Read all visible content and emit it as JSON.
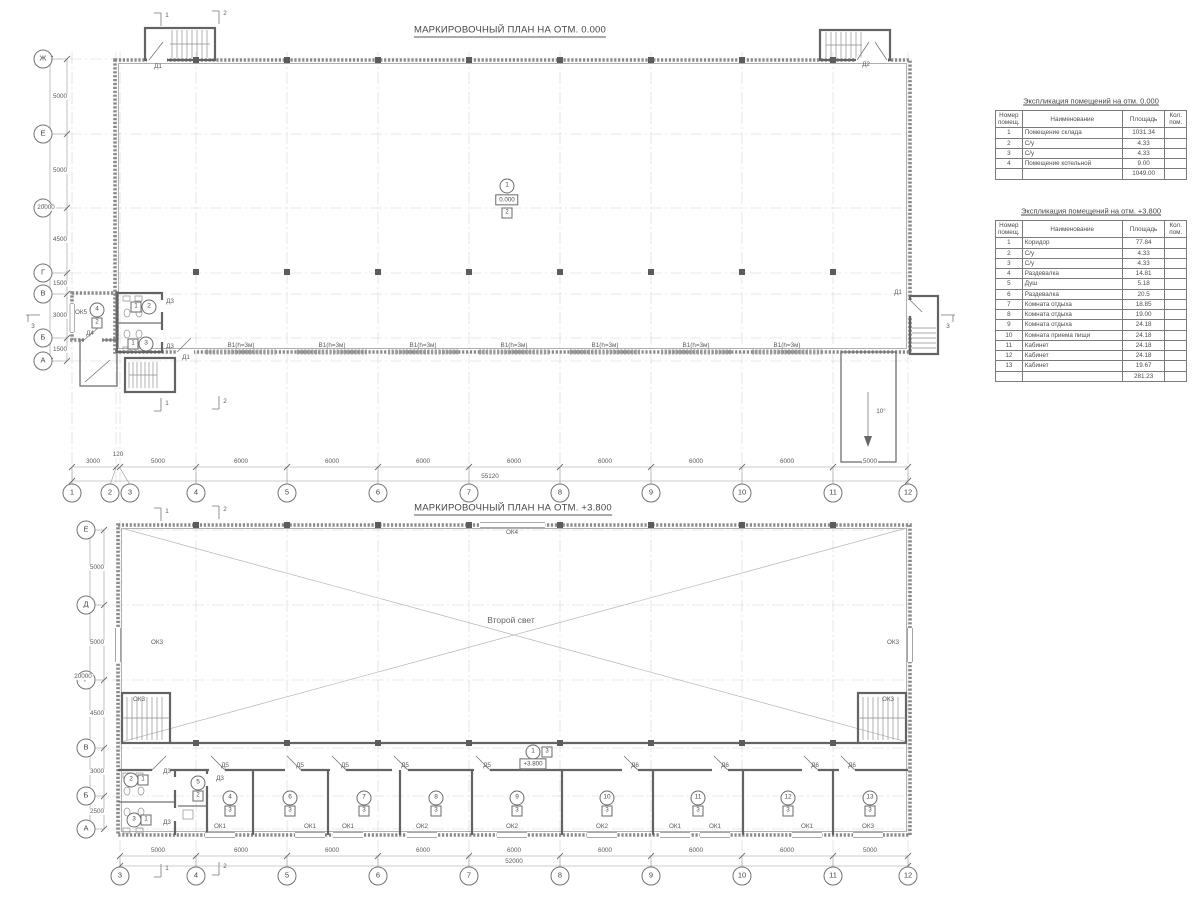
{
  "plans": [
    {
      "title": "МАРКИРОВОЧНЫЙ ПЛАН НА ОТМ. 0.000"
    },
    {
      "title": "МАРКИРОВОЧНЫЙ ПЛАН НА ОТМ. +3.800"
    }
  ],
  "axis_bubbles": [
    {
      "t": "1",
      "x": 72,
      "y": 493
    },
    {
      "t": "2",
      "x": 110,
      "y": 493
    },
    {
      "t": "3",
      "x": 130,
      "y": 493
    },
    {
      "t": "4",
      "x": 196,
      "y": 493
    },
    {
      "t": "5",
      "x": 287,
      "y": 493
    },
    {
      "t": "6",
      "x": 378,
      "y": 493
    },
    {
      "t": "7",
      "x": 469,
      "y": 493
    },
    {
      "t": "8",
      "x": 560,
      "y": 493
    },
    {
      "t": "9",
      "x": 651,
      "y": 493
    },
    {
      "t": "10",
      "x": 742,
      "y": 493
    },
    {
      "t": "11",
      "x": 833,
      "y": 493
    },
    {
      "t": "12",
      "x": 908,
      "y": 493
    },
    {
      "t": "Ж",
      "x": 43,
      "y": 59
    },
    {
      "t": "Е",
      "x": 43,
      "y": 134
    },
    {
      "t": "Д",
      "x": 43,
      "y": 208
    },
    {
      "t": "Г",
      "x": 43,
      "y": 273
    },
    {
      "t": "В",
      "x": 43,
      "y": 294
    },
    {
      "t": "Б",
      "x": 43,
      "y": 338
    },
    {
      "t": "А",
      "x": 43,
      "y": 361
    },
    {
      "t": "3",
      "x": 120,
      "y": 876
    },
    {
      "t": "4",
      "x": 196,
      "y": 876
    },
    {
      "t": "5",
      "x": 287,
      "y": 876
    },
    {
      "t": "6",
      "x": 378,
      "y": 876
    },
    {
      "t": "7",
      "x": 469,
      "y": 876
    },
    {
      "t": "8",
      "x": 560,
      "y": 876
    },
    {
      "t": "9",
      "x": 651,
      "y": 876
    },
    {
      "t": "10",
      "x": 742,
      "y": 876
    },
    {
      "t": "11",
      "x": 833,
      "y": 876
    },
    {
      "t": "12",
      "x": 908,
      "y": 876
    },
    {
      "t": "Е",
      "x": 86,
      "y": 530
    },
    {
      "t": "Д",
      "x": 86,
      "y": 605
    },
    {
      "t": "Г",
      "x": 86,
      "y": 680
    },
    {
      "t": "В",
      "x": 86,
      "y": 748
    },
    {
      "t": "Б",
      "x": 86,
      "y": 796
    },
    {
      "t": "А",
      "x": 86,
      "y": 829
    }
  ],
  "dimensions": [
    {
      "t": "3000",
      "x": 93,
      "y": 462
    },
    {
      "t": "120",
      "x": 118,
      "y": 455
    },
    {
      "t": "5000",
      "x": 158,
      "y": 462
    },
    {
      "t": "6000",
      "x": 241,
      "y": 462
    },
    {
      "t": "6000",
      "x": 332,
      "y": 462
    },
    {
      "t": "6000",
      "x": 423,
      "y": 462
    },
    {
      "t": "6000",
      "x": 514,
      "y": 462
    },
    {
      "t": "6000",
      "x": 605,
      "y": 462
    },
    {
      "t": "6000",
      "x": 696,
      "y": 462
    },
    {
      "t": "6000",
      "x": 787,
      "y": 462
    },
    {
      "t": "5000",
      "x": 870,
      "y": 462
    },
    {
      "t": "55120",
      "x": 490,
      "y": 477
    },
    {
      "t": "5000",
      "x": 60,
      "y": 97,
      "rot": 1
    },
    {
      "t": "5000",
      "x": 60,
      "y": 171,
      "rot": 1
    },
    {
      "t": "4500",
      "x": 60,
      "y": 240,
      "rot": 1
    },
    {
      "t": "1500",
      "x": 60,
      "y": 284,
      "rot": 1
    },
    {
      "t": "3000",
      "x": 60,
      "y": 316,
      "rot": 1
    },
    {
      "t": "1500",
      "x": 60,
      "y": 350,
      "rot": 1
    },
    {
      "t": "20000",
      "x": 46,
      "y": 208,
      "rot": 1
    },
    {
      "t": "5000",
      "x": 158,
      "y": 851
    },
    {
      "t": "6000",
      "x": 241,
      "y": 851
    },
    {
      "t": "6000",
      "x": 332,
      "y": 851
    },
    {
      "t": "6000",
      "x": 423,
      "y": 851
    },
    {
      "t": "6000",
      "x": 514,
      "y": 851
    },
    {
      "t": "6000",
      "x": 605,
      "y": 851
    },
    {
      "t": "6000",
      "x": 696,
      "y": 851
    },
    {
      "t": "6000",
      "x": 787,
      "y": 851
    },
    {
      "t": "5000",
      "x": 870,
      "y": 851
    },
    {
      "t": "52000",
      "x": 514,
      "y": 862
    },
    {
      "t": "5000",
      "x": 97,
      "y": 568,
      "rot": 1
    },
    {
      "t": "5000",
      "x": 97,
      "y": 643,
      "rot": 1
    },
    {
      "t": "4500",
      "x": 97,
      "y": 714,
      "rot": 1
    },
    {
      "t": "3000",
      "x": 97,
      "y": 772,
      "rot": 1
    },
    {
      "t": "2500",
      "x": 97,
      "y": 812,
      "rot": 1
    },
    {
      "t": "20000",
      "x": 83,
      "y": 677,
      "rot": 1
    }
  ],
  "annotations": [
    {
      "t": "Д1",
      "x": 158,
      "y": 67,
      "name": "door-label-d1"
    },
    {
      "t": "Д2",
      "x": 866,
      "y": 65,
      "name": "door-label-d2"
    },
    {
      "t": "Д1",
      "x": 186,
      "y": 358,
      "name": "door-label-d1"
    },
    {
      "t": "Д1",
      "x": 898,
      "y": 293,
      "name": "door-label-d1"
    },
    {
      "t": "Д3",
      "x": 170,
      "y": 302,
      "name": "door-label-d3"
    },
    {
      "t": "Д3",
      "x": 170,
      "y": 347,
      "name": "door-label-d3"
    },
    {
      "t": "Д4",
      "x": 90,
      "y": 334,
      "name": "door-label-d4"
    },
    {
      "t": "ОК5",
      "x": 81,
      "y": 313,
      "name": "window-label-ok5"
    },
    {
      "t": "В1(h=3м)",
      "x": 241,
      "y": 346,
      "name": "opening-label-v1"
    },
    {
      "t": "В1(h=3м)",
      "x": 332,
      "y": 346,
      "name": "opening-label-v1"
    },
    {
      "t": "В1(h=3м)",
      "x": 423,
      "y": 346,
      "name": "opening-label-v1"
    },
    {
      "t": "В1(h=3м)",
      "x": 514,
      "y": 346,
      "name": "opening-label-v1"
    },
    {
      "t": "В1(h=3м)",
      "x": 605,
      "y": 346,
      "name": "opening-label-v1"
    },
    {
      "t": "В1(h=3м)",
      "x": 696,
      "y": 346,
      "name": "opening-label-v1"
    },
    {
      "t": "В1(h=3м)",
      "x": 787,
      "y": 346,
      "name": "opening-label-v1"
    },
    {
      "t": "10°",
      "x": 881,
      "y": 412,
      "name": "ramp-slope-label"
    },
    {
      "t": "1",
      "x": 167,
      "y": 16,
      "name": "section-mark-1"
    },
    {
      "t": "2",
      "x": 225,
      "y": 14,
      "name": "section-mark-2"
    },
    {
      "t": "1",
      "x": 167,
      "y": 404,
      "name": "section-mark-1"
    },
    {
      "t": "2",
      "x": 225,
      "y": 402,
      "name": "section-mark-2"
    },
    {
      "t": "3",
      "x": 33,
      "y": 327,
      "name": "section-mark-3"
    },
    {
      "t": "3",
      "x": 948,
      "y": 327,
      "name": "section-mark-3"
    },
    {
      "t": "ОК4",
      "x": 512,
      "y": 533,
      "name": "window-label-ok4"
    },
    {
      "t": "ОК3",
      "x": 157,
      "y": 643,
      "name": "window-label-ok3"
    },
    {
      "t": "ОК3",
      "x": 893,
      "y": 643,
      "name": "window-label-ok3"
    },
    {
      "t": "ОК3",
      "x": 139,
      "y": 700,
      "name": "window-label-ok3"
    },
    {
      "t": "ОК3",
      "x": 888,
      "y": 700,
      "name": "window-label-ok3"
    },
    {
      "t": "Второй свет",
      "x": 511,
      "y": 620,
      "cls": "md",
      "name": "second-light-label"
    },
    {
      "t": "Д3",
      "x": 167,
      "y": 772,
      "name": "door-label-d3"
    },
    {
      "t": "Д3",
      "x": 220,
      "y": 779,
      "name": "door-label-d3"
    },
    {
      "t": "Д3",
      "x": 167,
      "y": 823,
      "name": "door-label-d3"
    },
    {
      "t": "Д5",
      "x": 225,
      "y": 766,
      "name": "door-label-d5"
    },
    {
      "t": "Д5",
      "x": 300,
      "y": 766,
      "name": "door-label-d5"
    },
    {
      "t": "Д5",
      "x": 345,
      "y": 766,
      "name": "door-label-d5"
    },
    {
      "t": "Д5",
      "x": 405,
      "y": 766,
      "name": "door-label-d5"
    },
    {
      "t": "Д5",
      "x": 487,
      "y": 766,
      "name": "door-label-d5"
    },
    {
      "t": "Д6",
      "x": 635,
      "y": 766,
      "name": "door-label-d6"
    },
    {
      "t": "Д6",
      "x": 725,
      "y": 766,
      "name": "door-label-d6"
    },
    {
      "t": "Д6",
      "x": 815,
      "y": 766,
      "name": "door-label-d6"
    },
    {
      "t": "Д6",
      "x": 852,
      "y": 766,
      "name": "door-label-d6"
    },
    {
      "t": "ОК1",
      "x": 220,
      "y": 827,
      "name": "window-label-ok1"
    },
    {
      "t": "ОК1",
      "x": 310,
      "y": 827,
      "name": "window-label-ok1"
    },
    {
      "t": "ОК1",
      "x": 348,
      "y": 827,
      "name": "window-label-ok1"
    },
    {
      "t": "ОК2",
      "x": 422,
      "y": 827,
      "name": "window-label-ok2"
    },
    {
      "t": "ОК2",
      "x": 512,
      "y": 827,
      "name": "window-label-ok2"
    },
    {
      "t": "ОК2",
      "x": 602,
      "y": 827,
      "name": "window-label-ok2"
    },
    {
      "t": "ОК1",
      "x": 675,
      "y": 827,
      "name": "window-label-ok1"
    },
    {
      "t": "ОК1",
      "x": 715,
      "y": 827,
      "name": "window-label-ok1"
    },
    {
      "t": "ОК1",
      "x": 807,
      "y": 827,
      "name": "window-label-ok1"
    },
    {
      "t": "ОК3",
      "x": 868,
      "y": 827,
      "name": "window-label-ok3"
    },
    {
      "t": "1",
      "x": 167,
      "y": 512,
      "name": "section-mark-1"
    },
    {
      "t": "2",
      "x": 225,
      "y": 510,
      "name": "section-mark-2"
    },
    {
      "t": "1",
      "x": 167,
      "y": 869,
      "name": "section-mark-1"
    },
    {
      "t": "2",
      "x": 225,
      "y": 867,
      "name": "section-mark-2"
    }
  ],
  "markers": [
    {
      "kind": "circle",
      "t": "1",
      "x": 507,
      "y": 186
    },
    {
      "kind": "box",
      "t": "0.000",
      "x": 507,
      "y": 200
    },
    {
      "kind": "square",
      "t": "2",
      "x": 507,
      "y": 213
    },
    {
      "kind": "circle",
      "t": "4",
      "x": 97,
      "y": 310
    },
    {
      "kind": "square",
      "t": "2",
      "x": 97,
      "y": 323
    },
    {
      "kind": "square",
      "t": "1",
      "x": 136,
      "y": 307
    },
    {
      "kind": "circle",
      "t": "2",
      "x": 149,
      "y": 307
    },
    {
      "kind": "square",
      "t": "1",
      "x": 133,
      "y": 344
    },
    {
      "kind": "circle",
      "t": "3",
      "x": 146,
      "y": 344
    },
    {
      "kind": "circle",
      "t": "1",
      "x": 533,
      "y": 752
    },
    {
      "kind": "square",
      "t": "3",
      "x": 547,
      "y": 752
    },
    {
      "kind": "box",
      "t": "+3.800",
      "x": 533,
      "y": 764
    },
    {
      "kind": "circle",
      "t": "2",
      "x": 131,
      "y": 780
    },
    {
      "kind": "square",
      "t": "1",
      "x": 143,
      "y": 780
    },
    {
      "kind": "circle",
      "t": "3",
      "x": 134,
      "y": 820
    },
    {
      "kind": "square",
      "t": "1",
      "x": 146,
      "y": 820
    },
    {
      "kind": "circle",
      "t": "5",
      "x": 198,
      "y": 783
    },
    {
      "kind": "square",
      "t": "2",
      "x": 198,
      "y": 796
    },
    {
      "kind": "circle",
      "t": "4",
      "x": 230,
      "y": 798
    },
    {
      "kind": "square",
      "t": "3",
      "x": 230,
      "y": 811
    },
    {
      "kind": "circle",
      "t": "6",
      "x": 290,
      "y": 798
    },
    {
      "kind": "square",
      "t": "3",
      "x": 290,
      "y": 811
    },
    {
      "kind": "circle",
      "t": "7",
      "x": 364,
      "y": 798
    },
    {
      "kind": "square",
      "t": "3",
      "x": 364,
      "y": 811
    },
    {
      "kind": "circle",
      "t": "8",
      "x": 436,
      "y": 798
    },
    {
      "kind": "square",
      "t": "3",
      "x": 436,
      "y": 811
    },
    {
      "kind": "circle",
      "t": "9",
      "x": 517,
      "y": 798
    },
    {
      "kind": "square",
      "t": "3",
      "x": 517,
      "y": 811
    },
    {
      "kind": "circle",
      "t": "10",
      "x": 607,
      "y": 798
    },
    {
      "kind": "square",
      "t": "3",
      "x": 607,
      "y": 811
    },
    {
      "kind": "circle",
      "t": "11",
      "x": 698,
      "y": 798
    },
    {
      "kind": "square",
      "t": "3",
      "x": 698,
      "y": 811
    },
    {
      "kind": "circle",
      "t": "12",
      "x": 788,
      "y": 798
    },
    {
      "kind": "square",
      "t": "3",
      "x": 788,
      "y": 811
    },
    {
      "kind": "circle",
      "t": "13",
      "x": 870,
      "y": 798
    },
    {
      "kind": "square",
      "t": "3",
      "x": 870,
      "y": 811
    }
  ],
  "tables": [
    {
      "title": "Экспликация помещений на отм. 0.000",
      "headers": [
        "Номер\nпомещ.",
        "Наименование",
        "Площадь",
        "Кол.\nпом."
      ],
      "rows": [
        [
          "1",
          "Помещение склада",
          "1031.34",
          ""
        ],
        [
          "2",
          "С/у",
          "4.33",
          ""
        ],
        [
          "3",
          "С/у",
          "4.33",
          ""
        ],
        [
          "4",
          "Помещение котельной",
          "9.00",
          ""
        ]
      ],
      "total": "1049.00"
    },
    {
      "title": "Экспликация помещений на отм. +3.800",
      "headers": [
        "Номер\nпомещ.",
        "Наименование",
        "Площадь",
        "Кол.\nпом."
      ],
      "rows": [
        [
          "1",
          "Коридор",
          "77.84",
          ""
        ],
        [
          "2",
          "С/у",
          "4.33",
          ""
        ],
        [
          "3",
          "С/у",
          "4.33",
          ""
        ],
        [
          "4",
          "Раздевалка",
          "14.81",
          ""
        ],
        [
          "5",
          "Душ",
          "5.18",
          ""
        ],
        [
          "6",
          "Раздевалка",
          "20.5",
          ""
        ],
        [
          "7",
          "Комната отдыха",
          "18.85",
          ""
        ],
        [
          "8",
          "Комната отдыха",
          "19.00",
          ""
        ],
        [
          "9",
          "Комната отдыха",
          "24.18",
          ""
        ],
        [
          "10",
          "Комната приема пищи",
          "24.18",
          ""
        ],
        [
          "11",
          "Кабинет",
          "24.18",
          ""
        ],
        [
          "12",
          "Кабинет",
          "24.18",
          ""
        ],
        [
          "13",
          "Кабинет",
          "19.67",
          ""
        ]
      ],
      "total": "281.23"
    }
  ]
}
